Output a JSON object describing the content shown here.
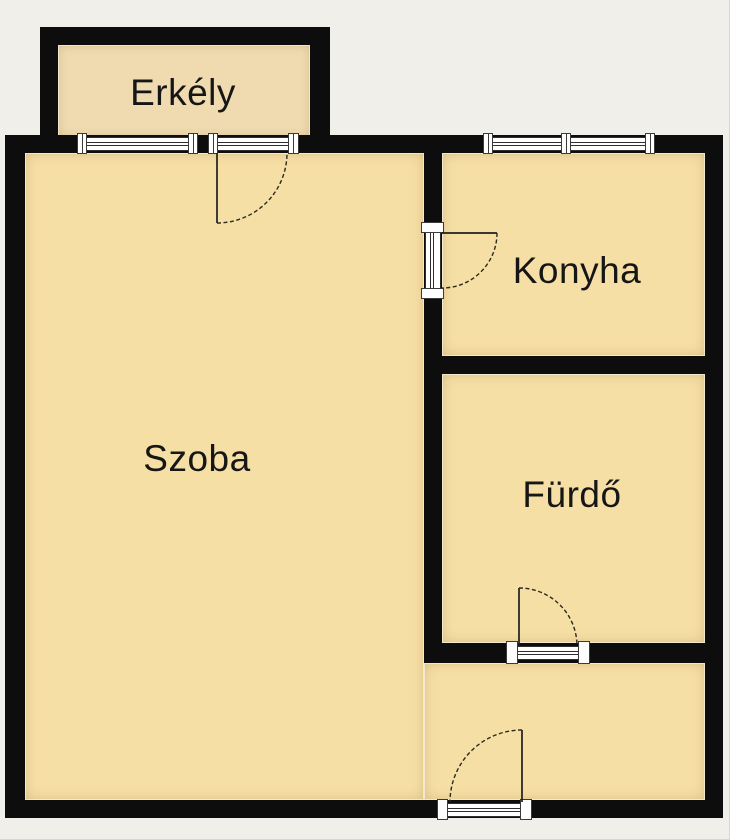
{
  "page": {
    "background_color": "#f1efe9",
    "type_hint": "apartment floor plan"
  },
  "floorplan": {
    "wall_color": "#0d0d0d",
    "room_fill_color": "#f5dfa5",
    "balcony_fill_color": "#f0dbb0",
    "opening_fill_color": "#ffffff",
    "rooms": [
      {
        "id": "erkely",
        "label": "Erkély"
      },
      {
        "id": "szoba",
        "label": "Szoba"
      },
      {
        "id": "konyha",
        "label": "Konyha"
      },
      {
        "id": "furdo",
        "label": "Fürdő"
      }
    ],
    "features": {
      "windows": [
        "balcony-window",
        "balcony-door-glazing",
        "kitchen-window"
      ],
      "doors": [
        "balcony-door",
        "kitchen-door",
        "bathroom-door",
        "entry-door"
      ]
    }
  }
}
